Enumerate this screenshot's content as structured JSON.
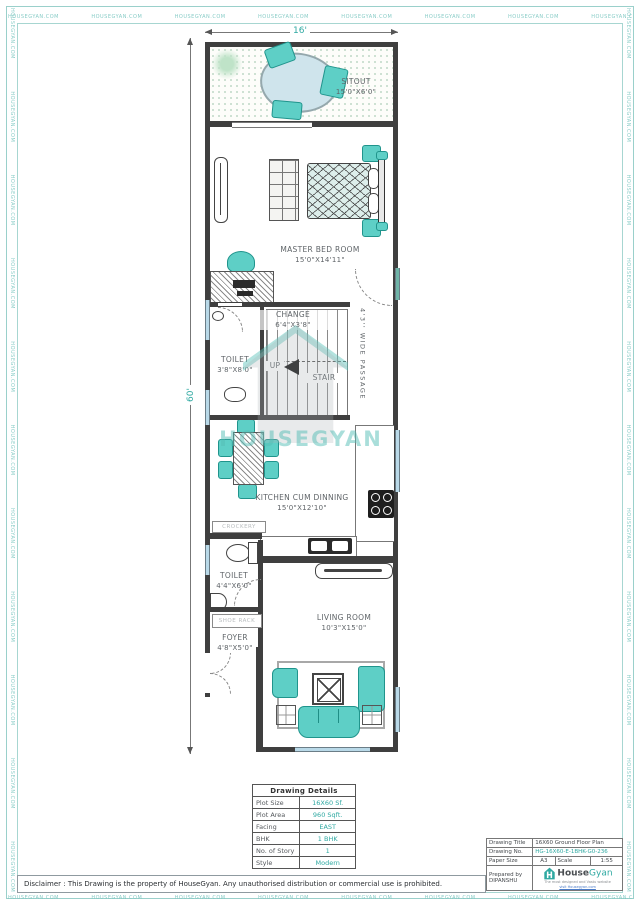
{
  "border": {
    "tape": "HOUSEGYAN.COM"
  },
  "dimensions": {
    "width_label": "16'",
    "height_label": "60'"
  },
  "watermark": {
    "text": "HOUSEGYAN"
  },
  "rooms": {
    "sitout": {
      "name": "SITOUT",
      "size": "15'0\"X6'0\""
    },
    "master_bed": {
      "name": "MASTER BED ROOM",
      "size": "15'0\"X14'11\""
    },
    "change": {
      "name": "CHANGE",
      "size": "6'4\"X3'8\""
    },
    "toilet_upper": {
      "name": "TOILET",
      "size": "3'8\"X8'0\""
    },
    "stair": {
      "label": "STAIR",
      "up": "UP"
    },
    "passage": {
      "label": "4'3'' WIDE PASSAGE"
    },
    "kitchen": {
      "name": "KITCHEN CUM DINNING",
      "size": "15'0\"X12'10\""
    },
    "crockery": {
      "label": "CROCKERY"
    },
    "toilet_lower": {
      "name": "TOILET",
      "size": "4'4\"X6'0\""
    },
    "shoe_rack": {
      "label": "SHOE RACK"
    },
    "foyer": {
      "name": "FOYER",
      "size": "4'8\"X5'0\""
    },
    "living": {
      "name": "LIVING ROOM",
      "size": "10'3\"X15'0\""
    }
  },
  "details_table": {
    "title": "Drawing Details",
    "rows": [
      {
        "label": "Plot Size",
        "value": "16X60 Sf."
      },
      {
        "label": "Plot Area",
        "value": "960 Sqft."
      },
      {
        "label": "Facing",
        "value": "EAST"
      },
      {
        "label": "BHK",
        "value": "1 BHK"
      },
      {
        "label": "No. of Story",
        "value": "1"
      },
      {
        "label": "Style",
        "value": "Modern"
      }
    ]
  },
  "title_block": {
    "drawing_title_label": "Drawing Title",
    "drawing_title": "16X60 Ground Floor Plan",
    "drawing_no_label": "Drawing No.",
    "drawing_no": "HG-16X60-E-1BHK-G0-236",
    "paper_size_label": "Paper Size",
    "paper_size": "A3",
    "scale_label": "Scale",
    "scale": "1:55",
    "prepared_by_label": "Prepared by",
    "prepared_by": "DIPANSHU"
  },
  "logo": {
    "brand_first": "House",
    "brand_second": "Gyan",
    "tagline_line1": "The most designed and Vastu website",
    "tagline_line2": "visit Housegyan.com",
    "mark_text": "HOUSEGYAN"
  },
  "disclaimer": "Disclaimer : This Drawing is the property of HouseGyan. Any unauthorised distribution or commercial use is prohibited.",
  "colors": {
    "accent_teal": "#2fa9a2",
    "furniture_teal": "#5ecfc6",
    "wall": "#3f3f3f",
    "window_blue": "#b9d9e8"
  }
}
